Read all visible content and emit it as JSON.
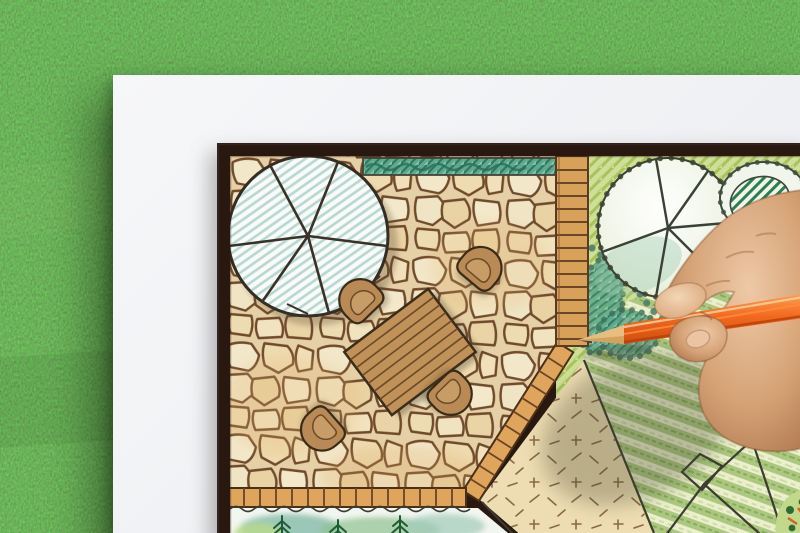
{
  "scene": {
    "description": "Overhead photograph of a hand drawing a garden landscape architecture plan with an orange colored pencil on a white sheet lying on green artificial grass",
    "background": {
      "label": "artificial grass lawn"
    },
    "paper": {
      "label": "white plan sheet"
    },
    "plan": {
      "frame": {
        "label": "dark brown plan border"
      },
      "areas": [
        {
          "id": "patio",
          "label": "flagstone patio"
        },
        {
          "id": "umbrella",
          "label": "patio umbrella symbol with radial ribs"
        },
        {
          "id": "table",
          "label": "rectangular wooden garden table"
        },
        {
          "id": "chairs",
          "label": "four rounded tub chairs",
          "count": 4
        },
        {
          "id": "hedge",
          "label": "teal hedge strip"
        },
        {
          "id": "walkway",
          "label": "timber plank walkway"
        },
        {
          "id": "garden",
          "label": "yellow-green planting area"
        },
        {
          "id": "tree",
          "label": "large round tree symbol with spokes"
        },
        {
          "id": "shrub",
          "label": "dark-green hatched shrub symbol"
        },
        {
          "id": "shrub-band",
          "label": "scalloped teal shrub mass"
        },
        {
          "id": "lawn",
          "label": "striped green lawn"
        },
        {
          "id": "groundcover",
          "label": "cross-hatched groundcover bed"
        },
        {
          "id": "border-bed",
          "label": "fern planting border bed"
        },
        {
          "id": "paver-edge",
          "label": "brick paver edging"
        },
        {
          "id": "boulders",
          "label": "outlined rock cluster"
        },
        {
          "id": "flowers",
          "label": "flower bed corner"
        }
      ]
    },
    "hand": {
      "label": "right hand holding pencil"
    },
    "pencil": {
      "label": "orange colored pencil with sharpened tip"
    }
  },
  "colors": {
    "grass": "#47713b",
    "paper": "#f6f7f9",
    "frame": "#281810",
    "stoneBase": "#efe0bd",
    "stoneLine": "#6b4527",
    "hedgeTeal": "#5fa98e",
    "gardenGreen": "#cfdf97",
    "lawnGreen": "#a9c67c",
    "paver": "#dfa55c",
    "walkway": "#d8a159",
    "tableWood": "#c09158",
    "chairWood": "#b98a55",
    "pencilOrange": "#f26a1f",
    "pencilWood": "#e8bd80",
    "skinMid": "#d5a276",
    "skinShadow": "#a97049"
  }
}
